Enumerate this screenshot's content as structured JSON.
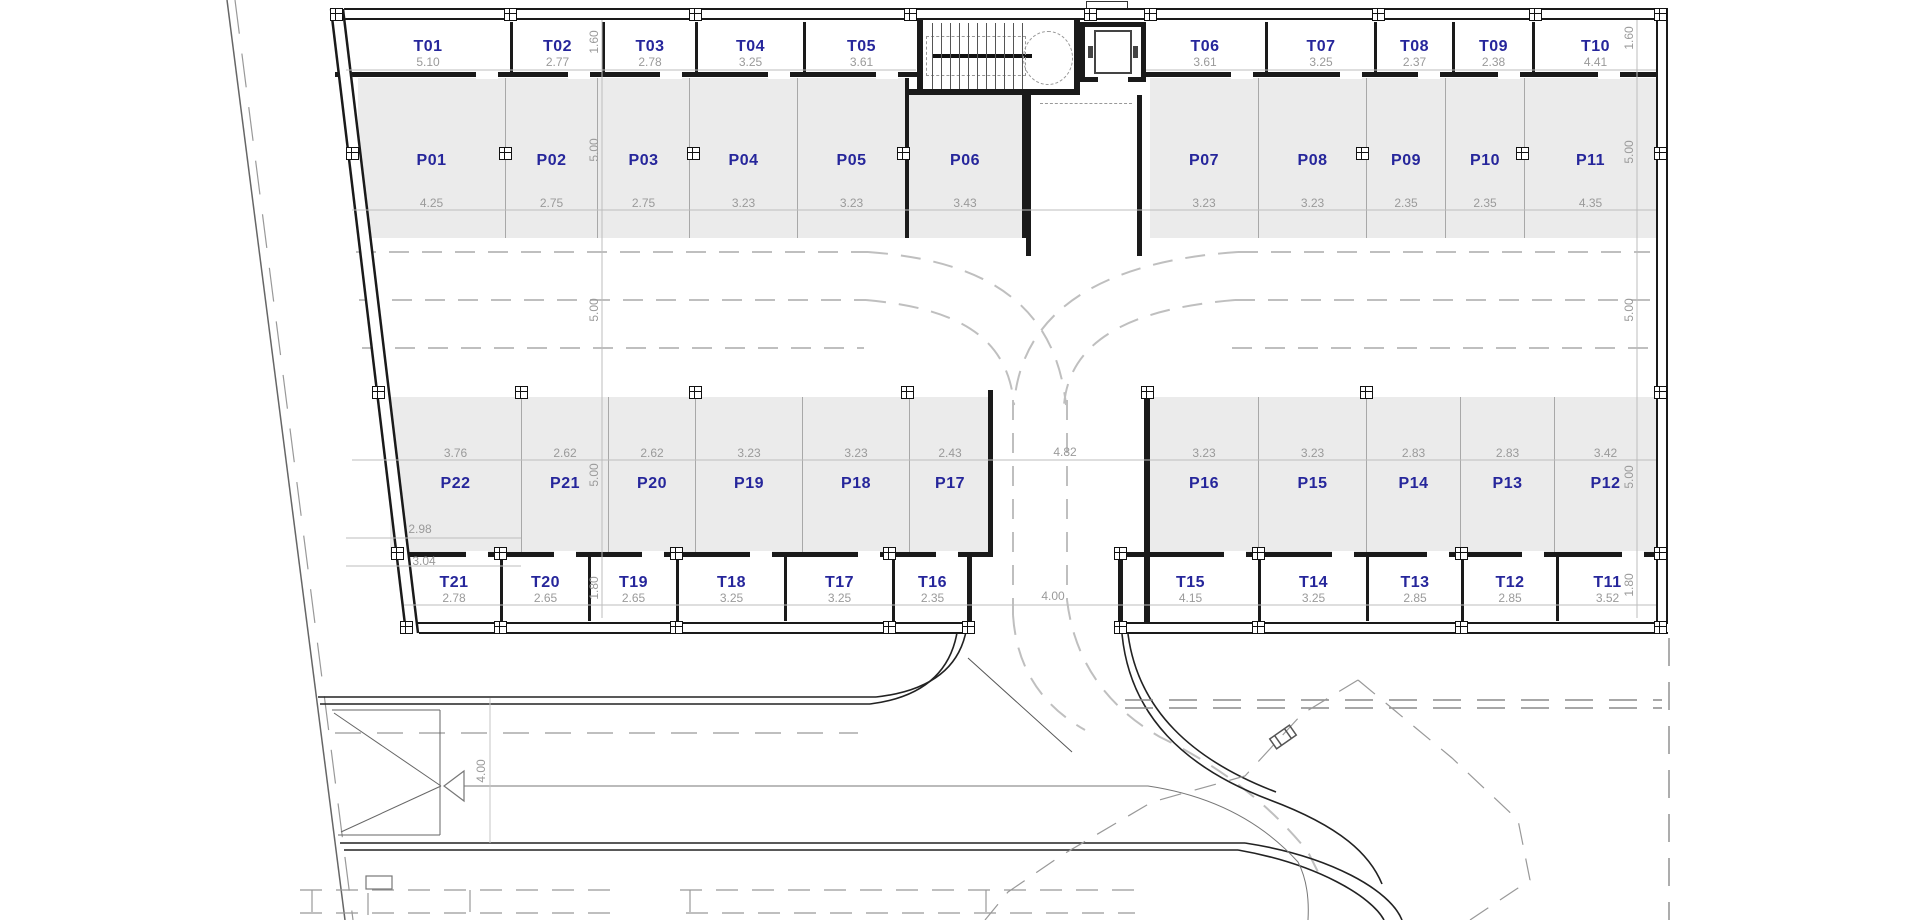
{
  "plan": {
    "colors": {
      "room_label": "#26269b",
      "dim_text": "#9a9a9a",
      "parking_fill": "#ebebeb",
      "wall": "#1a1a1a"
    },
    "rooms": {
      "top_t": [
        {
          "id": "T01",
          "dim": "5.10",
          "x": 346,
          "w": 164,
          "first": true
        },
        {
          "id": "T02",
          "dim": "2.77",
          "x": 510,
          "w": 92
        },
        {
          "id": "T03",
          "dim": "2.78",
          "x": 602,
          "w": 93
        },
        {
          "id": "T04",
          "dim": "3.25",
          "x": 695,
          "w": 108
        },
        {
          "id": "T05",
          "dim": "3.61",
          "x": 803,
          "w": 114
        },
        {
          "id": "T06",
          "dim": "3.61",
          "x": 1145,
          "w": 120,
          "first": true
        },
        {
          "id": "T07",
          "dim": "3.25",
          "x": 1265,
          "w": 109
        },
        {
          "id": "T08",
          "dim": "2.37",
          "x": 1374,
          "w": 78
        },
        {
          "id": "T09",
          "dim": "2.38",
          "x": 1452,
          "w": 80
        },
        {
          "id": "T10",
          "dim": "4.41",
          "x": 1532,
          "w": 124
        }
      ],
      "top_p": [
        {
          "id": "P01",
          "dim": "4.25",
          "x": 358,
          "w": 147,
          "first": true
        },
        {
          "id": "P02",
          "dim": "2.75",
          "x": 505,
          "w": 92
        },
        {
          "id": "P03",
          "dim": "2.75",
          "x": 597,
          "w": 92
        },
        {
          "id": "P04",
          "dim": "3.23",
          "x": 689,
          "w": 108
        },
        {
          "id": "P05",
          "dim": "3.23",
          "x": 797,
          "w": 108
        },
        {
          "id": "P06",
          "dim": "3.43",
          "x": 908,
          "w": 114,
          "first": true,
          "y": 93,
          "h": 145
        },
        {
          "id": "P07",
          "dim": "3.23",
          "x": 1150,
          "w": 108,
          "first": true
        },
        {
          "id": "P08",
          "dim": "3.23",
          "x": 1258,
          "w": 108
        },
        {
          "id": "P09",
          "dim": "2.35",
          "x": 1366,
          "w": 79
        },
        {
          "id": "P10",
          "dim": "2.35",
          "x": 1445,
          "w": 79
        },
        {
          "id": "P11",
          "dim": "4.35",
          "x": 1524,
          "w": 132
        }
      ],
      "bottom_p": [
        {
          "id": "P22",
          "dim": "3.76",
          "x": 390,
          "w": 131,
          "first": true
        },
        {
          "id": "P21",
          "dim": "2.62",
          "x": 521,
          "w": 87
        },
        {
          "id": "P20",
          "dim": "2.62",
          "x": 608,
          "w": 87
        },
        {
          "id": "P19",
          "dim": "3.23",
          "x": 695,
          "w": 107
        },
        {
          "id": "P18",
          "dim": "3.23",
          "x": 802,
          "w": 107
        },
        {
          "id": "P17",
          "dim": "2.43",
          "x": 909,
          "w": 81
        },
        {
          "id": "P16",
          "dim": "3.23",
          "x": 1150,
          "w": 108,
          "first": true
        },
        {
          "id": "P15",
          "dim": "3.23",
          "x": 1258,
          "w": 108
        },
        {
          "id": "P14",
          "dim": "2.83",
          "x": 1366,
          "w": 94
        },
        {
          "id": "P13",
          "dim": "2.83",
          "x": 1460,
          "w": 94
        },
        {
          "id": "P12",
          "dim": "3.42",
          "x": 1554,
          "w": 102
        }
      ],
      "bottom_t": [
        {
          "id": "T21",
          "dim": "2.78",
          "x": 408,
          "w": 92,
          "first": true
        },
        {
          "id": "T20",
          "dim": "2.65",
          "x": 500,
          "w": 88
        },
        {
          "id": "T19",
          "dim": "2.65",
          "x": 588,
          "w": 88
        },
        {
          "id": "T18",
          "dim": "3.25",
          "x": 676,
          "w": 108
        },
        {
          "id": "T17",
          "dim": "3.25",
          "x": 784,
          "w": 108
        },
        {
          "id": "T16",
          "dim": "2.35",
          "x": 892,
          "w": 78
        },
        {
          "id": "T15",
          "dim": "4.15",
          "x": 1123,
          "w": 135,
          "first": true
        },
        {
          "id": "T14",
          "dim": "3.25",
          "x": 1258,
          "w": 108
        },
        {
          "id": "T13",
          "dim": "2.85",
          "x": 1366,
          "w": 95
        },
        {
          "id": "T12",
          "dim": "2.85",
          "x": 1461,
          "w": 95
        },
        {
          "id": "T11",
          "dim": "3.52",
          "x": 1556,
          "w": 100
        }
      ]
    },
    "floating_dims": [
      {
        "text": "1.60",
        "x": 594,
        "y": 42,
        "rot": true
      },
      {
        "text": "5.00",
        "x": 594,
        "y": 150,
        "rot": true
      },
      {
        "text": "5.00",
        "x": 594,
        "y": 310,
        "rot": true
      },
      {
        "text": "5.00",
        "x": 594,
        "y": 475,
        "rot": true
      },
      {
        "text": "1.80",
        "x": 594,
        "y": 588,
        "rot": true
      },
      {
        "text": "1.60",
        "x": 1629,
        "y": 38,
        "rot": true
      },
      {
        "text": "5.00",
        "x": 1629,
        "y": 152,
        "rot": true
      },
      {
        "text": "5.00",
        "x": 1629,
        "y": 310,
        "rot": true
      },
      {
        "text": "5.00",
        "x": 1629,
        "y": 477,
        "rot": true
      },
      {
        "text": "1.80",
        "x": 1629,
        "y": 585,
        "rot": true
      },
      {
        "text": "4.82",
        "x": 1065,
        "y": 452,
        "rot": false
      },
      {
        "text": "4.00",
        "x": 1053,
        "y": 596,
        "rot": false
      },
      {
        "text": "2.98",
        "x": 420,
        "y": 529,
        "rot": false
      },
      {
        "text": "3.04",
        "x": 424,
        "y": 561,
        "rot": false
      },
      {
        "text": "4.00",
        "x": 481,
        "y": 771,
        "rot": true
      }
    ]
  }
}
